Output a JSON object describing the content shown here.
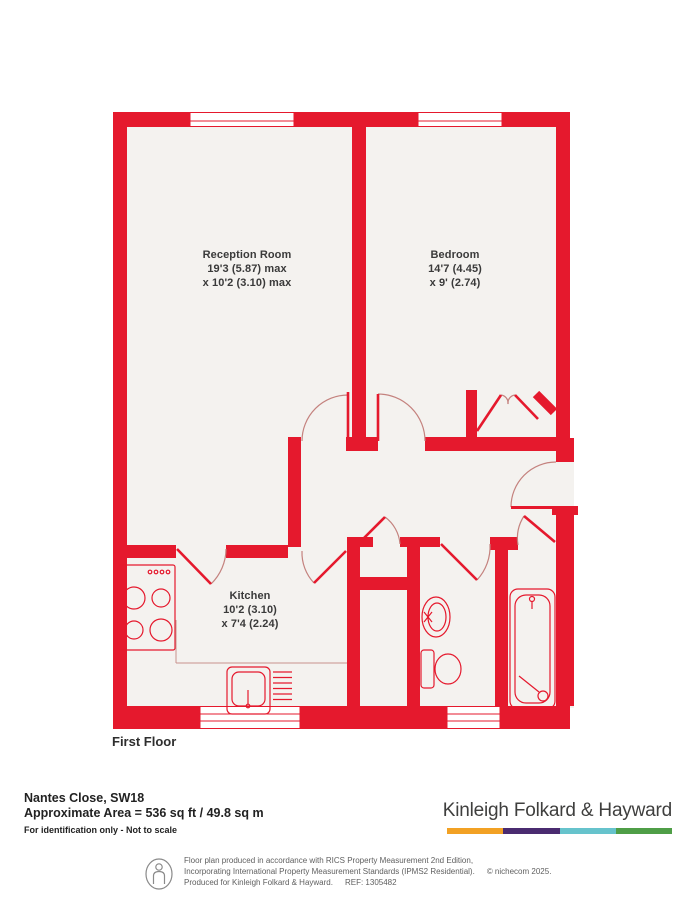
{
  "plan": {
    "floor_label": "First Floor",
    "rooms": [
      {
        "name": "Reception Room",
        "dim1": "19'3 (5.87) max",
        "dim2": "x 10'2 (3.10) max"
      },
      {
        "name": "Bedroom",
        "dim1": "14'7 (4.45)",
        "dim2": "x 9' (2.74)"
      },
      {
        "name": "Kitchen",
        "dim1": "10'2 (3.10)",
        "dim2": "x 7'4 (2.24)"
      }
    ]
  },
  "details": {
    "address": "Nantes Close, SW18",
    "area": "Approximate Area = 536 sq ft / 49.8 sq m",
    "disclaimer": "For identification only - Not to scale"
  },
  "branding": {
    "agency": "Kinleigh Folkard & Hayward",
    "bar_colors": [
      "#F2A124",
      "#4A2B70",
      "#66C3CC",
      "#4F9E47"
    ]
  },
  "footer": {
    "line1": "Floor plan produced in accordance with RICS Property Measurement 2nd Edition,",
    "line2": "Incorporating International Property Measurement Standards (IPMS2 Residential).",
    "copyright": "© nichecom 2025.",
    "line3": "Produced for Kinleigh Folkard & Hayward.",
    "ref": "REF: 1305482"
  },
  "colors": {
    "wall": "#E5192D",
    "floor": "#F4F2EF",
    "door_arc": "#C4827E"
  }
}
